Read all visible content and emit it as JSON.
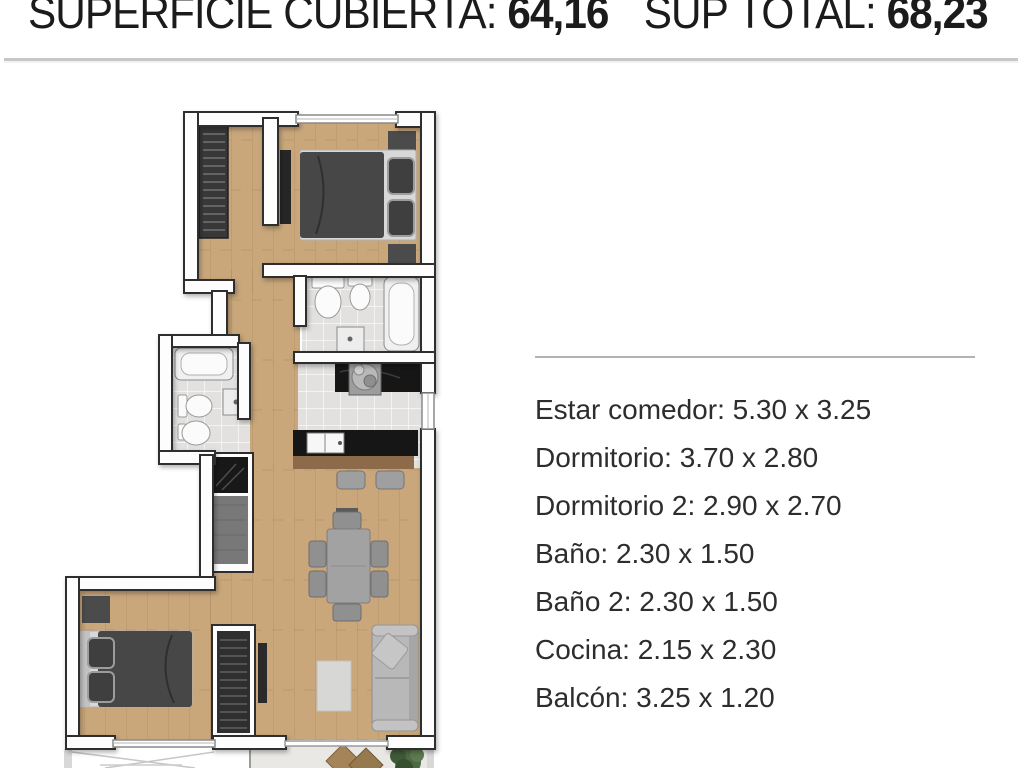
{
  "header": {
    "covered_label": "SUPERFICIE CUBIERTA:",
    "covered_value": "64,16",
    "total_label": "SUP TOTAL:",
    "total_value": "68,23"
  },
  "rooms": {
    "items": [
      {
        "label": "Estar comedor",
        "size": "5.30 x 3.25",
        "text": "Estar comedor: 5.30 x 3.25"
      },
      {
        "label": "Dormitorio",
        "size": "3.70 x 2.80",
        "text": "Dormitorio: 3.70 x 2.80"
      },
      {
        "label": "Dormitorio 2",
        "size": "2.90 x 2.70",
        "text": "Dormitorio 2: 2.90 x 2.70"
      },
      {
        "label": "Baño",
        "size": "2.30 x 1.50",
        "text": "Baño: 2.30 x 1.50"
      },
      {
        "label": "Baño 2",
        "size": "2.30 x 1.50",
        "text": "Baño 2: 2.30 x 1.50"
      },
      {
        "label": "Cocina",
        "size": "2.15 x 2.30",
        "text": "Cocina: 2.15 x 2.30"
      },
      {
        "label": "Balcón",
        "size": "3.25 x 1.20",
        "text": "Balcón: 3.25 x 1.20"
      }
    ]
  },
  "floorplan": {
    "colors": {
      "wood": "#c9a77b",
      "tile": "#e2e1df",
      "balcony": "#e9e8e5",
      "wall_fill": "#fdfdfd",
      "wall_stroke": "#2e2e2e",
      "counter": "#161616",
      "bar": "#8d6b4a",
      "bed_dark": "#474747",
      "wardrobe": "#383838",
      "sofa": "#b8b8b8",
      "plant": "#4e6a43"
    }
  }
}
